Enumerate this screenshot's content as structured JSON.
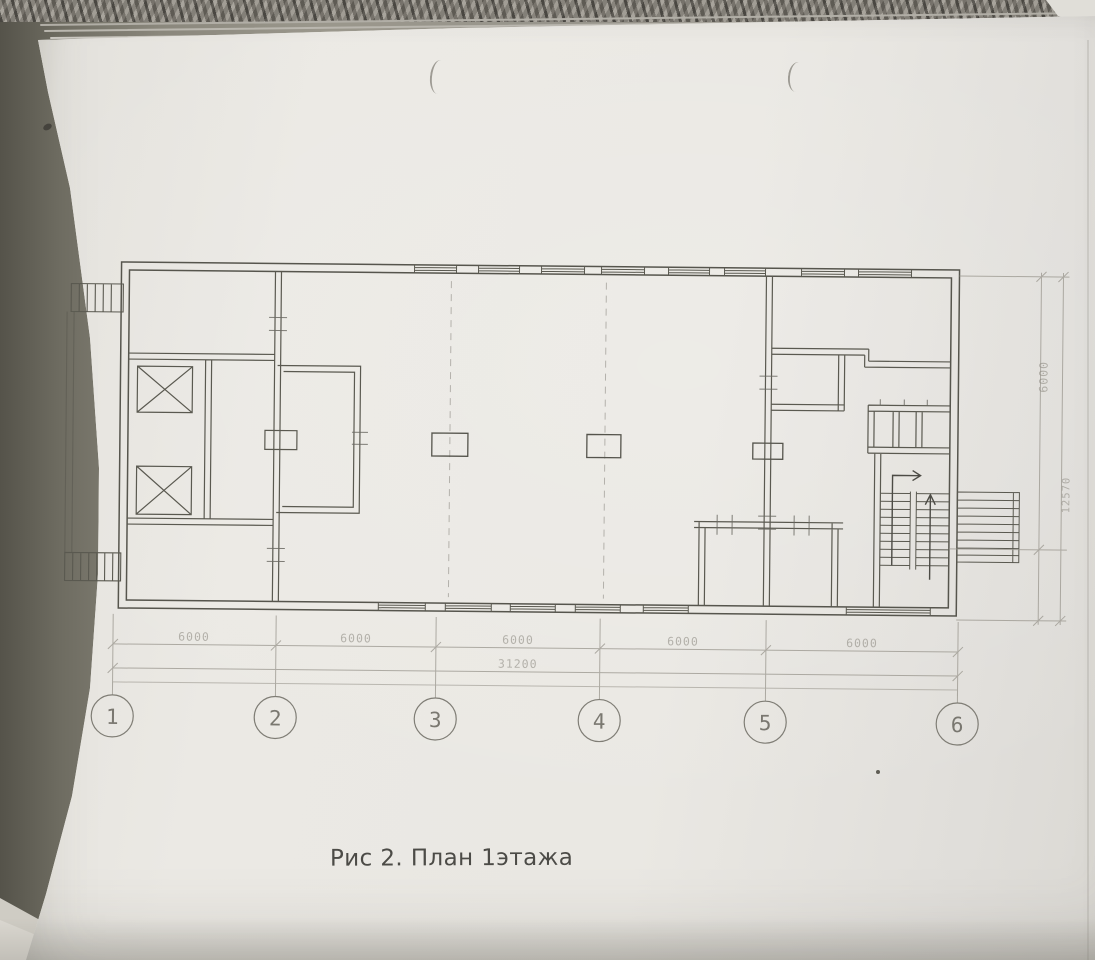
{
  "figure": {
    "caption": "Рис 2. План 1этажа"
  },
  "plan": {
    "axis_labels": [
      "1",
      "2",
      "3",
      "4",
      "5",
      "6"
    ],
    "bay_dimensions": [
      "6000",
      "6000",
      "6000",
      "6000",
      "6000"
    ],
    "total_dimension": "31200",
    "side_dimensions": {
      "upper": "6000",
      "lower": "12570"
    }
  },
  "colors": {
    "paper": "#e9e7e2",
    "ink": "#56554d",
    "faint_ink": "#94918a"
  }
}
